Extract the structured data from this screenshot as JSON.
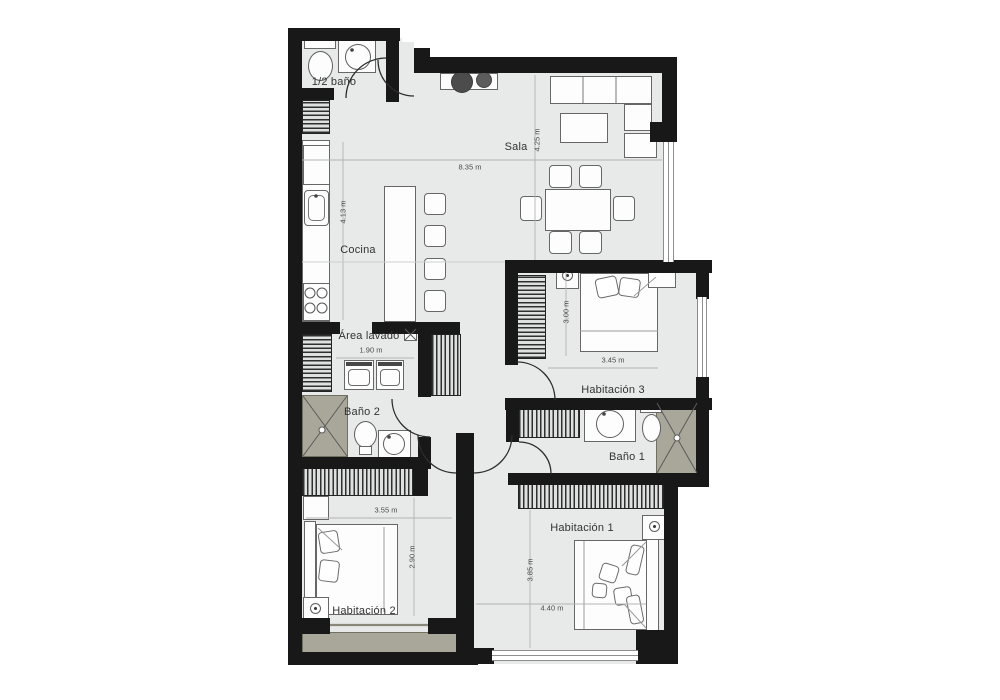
{
  "title": "Apartment floor plan",
  "colors": {
    "wall": "#181818",
    "floor": "#e8e9e9",
    "shower_and_balcony": "#a9a79a",
    "hatch": "#2f2f2f",
    "furniture_outline": "#676767",
    "label_text": "#333333",
    "dim_text": "#4a4a4a",
    "decor_dark": "#4c4c4c"
  },
  "rooms": {
    "sala": {
      "label": "Sala",
      "width": "8.35 m",
      "height": "4.25 m"
    },
    "cocina": {
      "label": "Cocina",
      "height": "4.13 m"
    },
    "area_lavado": {
      "label": "Área lavado",
      "width": "1.90 m"
    },
    "medio_bano": {
      "label": "1/2 baño"
    },
    "bano_1": {
      "label": "Baño 1"
    },
    "bano_2": {
      "label": "Baño 2"
    },
    "habitacion_1": {
      "label": "Habitación 1",
      "width": "4.40 m",
      "height": "3.85 m"
    },
    "habitacion_2": {
      "label": "Habitación 2",
      "width": "3.55 m",
      "height": "2.90 m"
    },
    "habitacion_3": {
      "label": "Habitación 3",
      "width": "3.45 m",
      "height": "3.00 m"
    }
  }
}
